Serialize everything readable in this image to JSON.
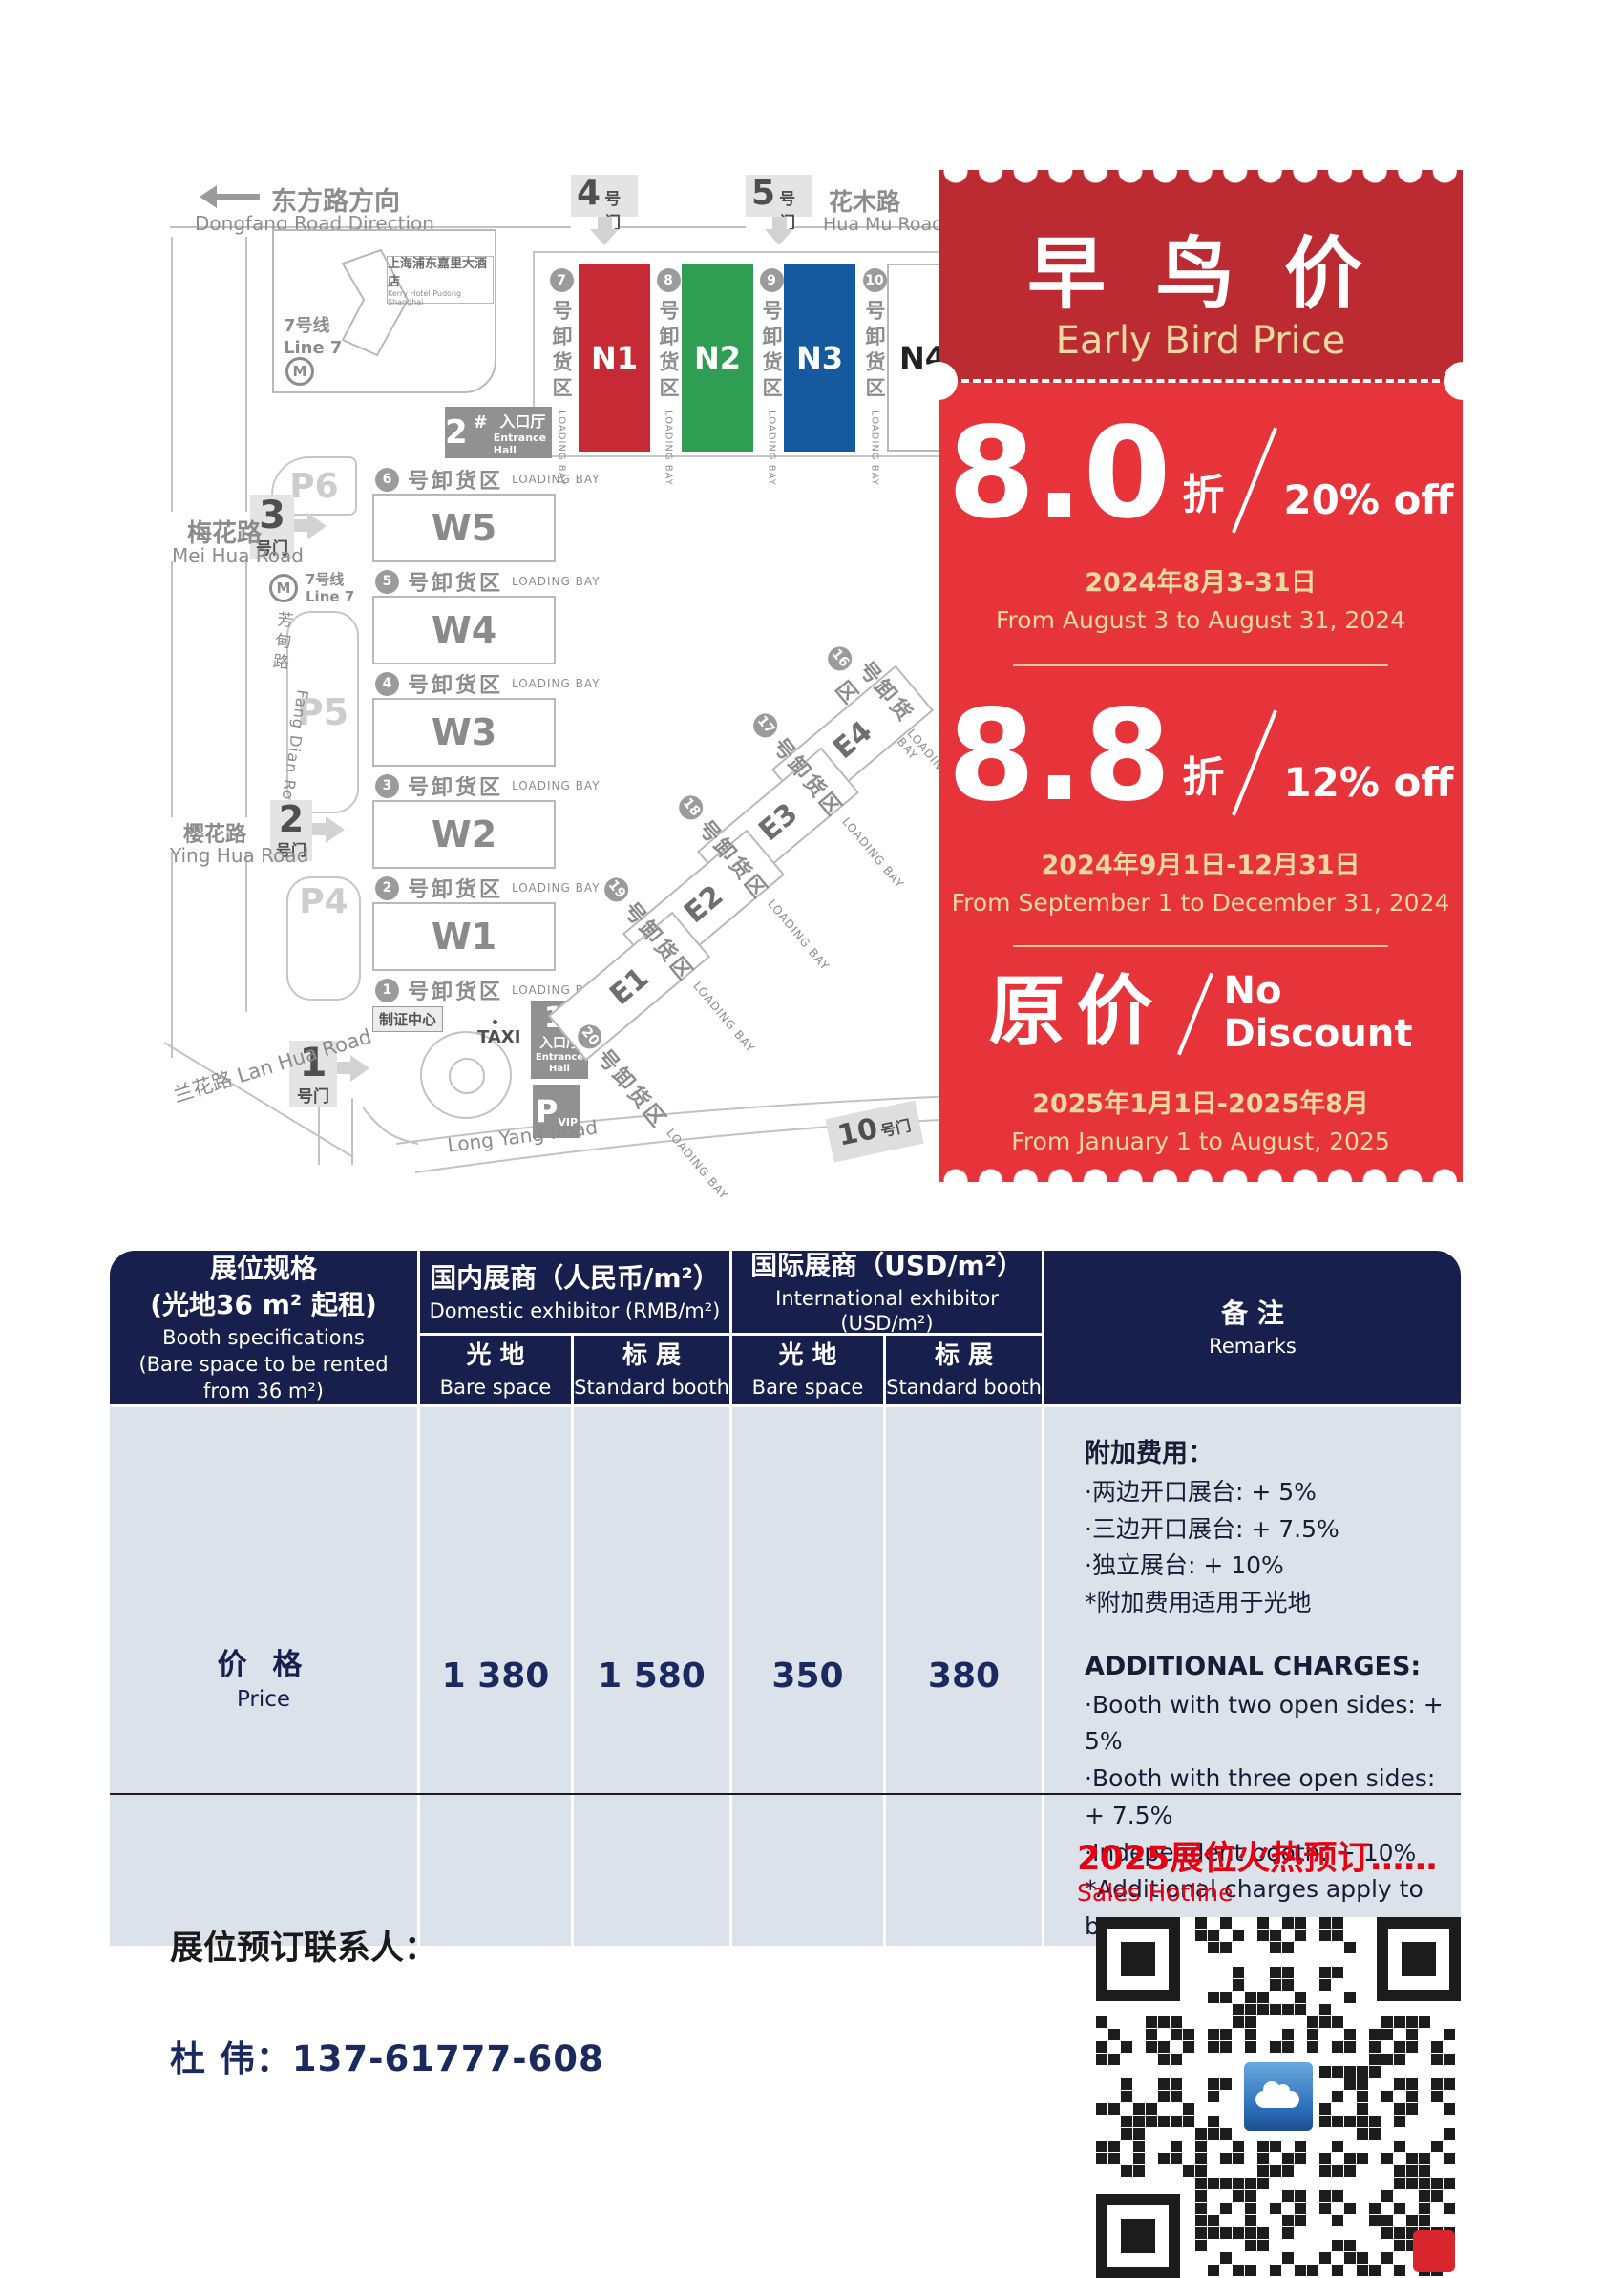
{
  "map": {
    "dongfang": {
      "zh": "东方路方向",
      "en": "Dongfang Road Direction"
    },
    "huamu": {
      "zh": "花木路",
      "en": "Hua Mu Road"
    },
    "meihua": {
      "zh": "梅花路",
      "en": "Mei Hua Road"
    },
    "fangdian": {
      "zh": "芳甸路",
      "en": "Fang Dian Road"
    },
    "yinghua": {
      "zh": "樱花路",
      "en": "Ying Hua Road"
    },
    "lanhua": {
      "label": "兰花路 Lan Hua Road"
    },
    "longyang": {
      "en": "Long Yang Road"
    },
    "hotel": {
      "zh": "上海浦东嘉里大酒店",
      "en": "Kerry Hotel Pudong Shanghai"
    },
    "line7": {
      "zh": "7号线",
      "en": "Line 7"
    },
    "metro_m": "M",
    "gate_suffix": "号门",
    "gates": {
      "g1": "1",
      "g2": "2",
      "g3": "3",
      "g4": "4",
      "g5": "5",
      "g10": "10"
    },
    "entrance1": {
      "num": "1",
      "hash": "#",
      "zh": "入口厅",
      "en": "Entrance Hall"
    },
    "entrance2": {
      "num": "2",
      "hash": "#",
      "zh": "入口厅",
      "en": "Entrance Hall"
    },
    "taxi": "TAXI",
    "pvip": {
      "p": "P",
      "vip": "VIP"
    },
    "zhizheng": "制证中心",
    "parking": {
      "p4": "P4",
      "p5": "P5",
      "p6": "P6"
    },
    "bay_zh": "号卸货区",
    "bay_en": "LOADING BAY",
    "n_bays": [
      "7",
      "8",
      "9",
      "10"
    ],
    "w_bays": [
      "6",
      "5",
      "4",
      "3",
      "2",
      "1"
    ],
    "e_bays": [
      "16",
      "17",
      "18",
      "19",
      "20"
    ],
    "n_halls": [
      "N1",
      "N2",
      "N3",
      "N4"
    ],
    "w_halls": [
      "W5",
      "W4",
      "W3",
      "W2",
      "W1"
    ],
    "e_halls": [
      "E4",
      "E3",
      "E2",
      "E1"
    ]
  },
  "promo": {
    "title_zh": "早 鸟 价",
    "title_en": "Early Bird Price",
    "tiers": [
      {
        "big": "8.0",
        "zhe": "折",
        "off": "20% off",
        "date_zh": "2024年8月3-31日",
        "date_en": "From August 3 to August 31, 2024"
      },
      {
        "big": "8.8",
        "zhe": "折",
        "off": "12% off",
        "date_zh": "2024年9月1日-12月31日",
        "date_en": "From September 1 to December 31, 2024"
      },
      {
        "big": "原价",
        "off_line1": "No",
        "off_line2": "Discount",
        "date_zh": "2025年1月1日-2025年8月",
        "date_en": "From January 1 to August, 2025"
      }
    ]
  },
  "table": {
    "spec": {
      "zh1": "展位规格",
      "zh2": "(光地36 m² 起租)",
      "en1": "Booth specifications",
      "en2": "(Bare space to be rented",
      "en3": "from 36 m²)"
    },
    "groups": [
      {
        "zh": "国内展商（人民币/m²）",
        "en": "Domestic exhibitor (RMB/m²)"
      },
      {
        "zh": "国际展商（USD/m²）",
        "en": "International exhibitor (USD/m²)"
      }
    ],
    "sub": {
      "bare_zh": "光 地",
      "bare_en": "Bare space",
      "std_zh": "标 展",
      "std_en": "Standard booth"
    },
    "remarks_header": {
      "zh": "备 注",
      "en": "Remarks"
    },
    "price": {
      "zh": "价 格",
      "en": "Price"
    },
    "values": [
      "1 380",
      "1 580",
      "350",
      "380"
    ],
    "remarks": {
      "zh_title": "附加费用：",
      "zh_items": [
        "·两边开口展台: + 5%",
        "·三边开口展台: + 7.5%",
        "·独立展台: + 10%",
        "*附加费用适用于光地"
      ],
      "en_title": "ADDITIONAL CHARGES:",
      "en_items": [
        "·Booth with two open sides: + 5%",
        "·Booth with three open sides: + 7.5%",
        "·Independent booth: + 10%",
        "*Additional charges apply to bare space"
      ]
    }
  },
  "footer": {
    "hotline_zh": "2025展位火热预订……",
    "hotline_en": "Sales Hotline",
    "contact_label": "展位预订联系人：",
    "contact_person": "杜  伟：137-61777-608"
  },
  "colors": {
    "ticket_body_red": "#e7343a",
    "ticket_head_red": "#bd2b32",
    "gold": "#ecd9a0",
    "table_navy": "#171f4d",
    "table_body_gray": "#dce2e9",
    "hall_n1_red": "#c62a35",
    "hall_n2_green": "#2f9e53",
    "hall_n3_blue": "#155a9e",
    "footer_red": "#e60012",
    "phone_navy": "#1b2a5e"
  }
}
